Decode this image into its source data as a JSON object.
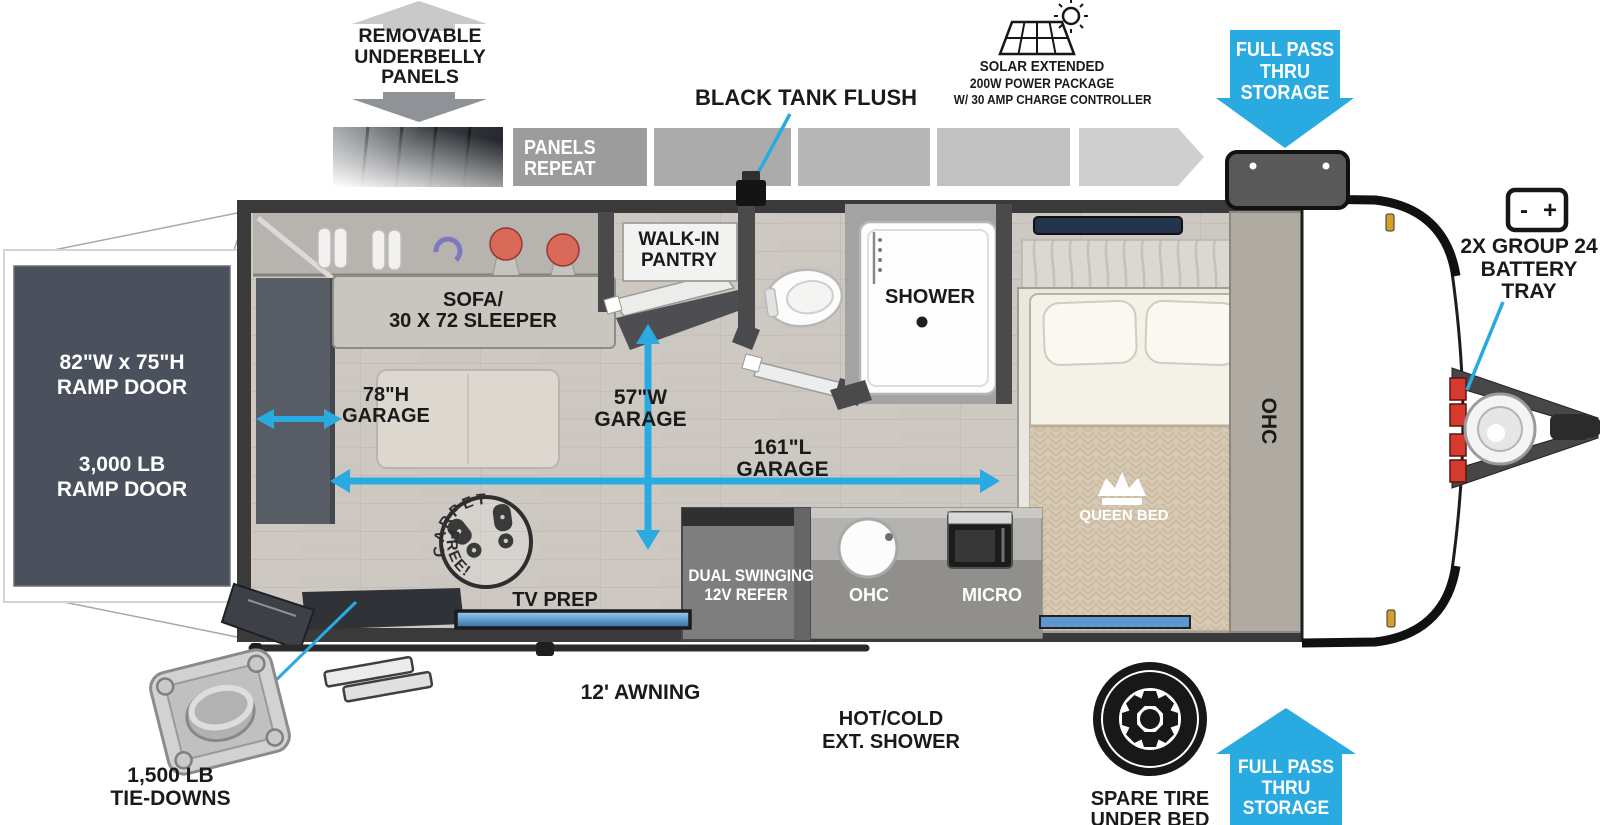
{
  "colors": {
    "accent_blue": "#29ABE2",
    "label_black": "#1a1a1a",
    "wall_gray": "#3a3a3a",
    "ramp_door_gray": "#4b515c",
    "floor_gray": "#cdc9c2"
  },
  "annotations": {
    "underbelly": {
      "lines": [
        "REMOVABLE",
        "UNDERBELLY",
        "PANELS"
      ]
    },
    "panels_repeat": {
      "lines": [
        "PANELS",
        "REPEAT"
      ]
    },
    "black_tank_flush": {
      "label": "BLACK TANK FLUSH"
    },
    "solar": {
      "lines": [
        "SOLAR EXTENDED",
        "200W POWER PACKAGE",
        "W/ 30 AMP CHARGE CONTROLLER"
      ]
    },
    "full_pass_top": {
      "lines": [
        "FULL PASS",
        "THRU",
        "STORAGE"
      ]
    },
    "battery_tray": {
      "minus": "-",
      "plus": "+",
      "lines": [
        "2X GROUP 24",
        "BATTERY",
        "TRAY"
      ]
    },
    "tie_downs": {
      "lines": [
        "1,500 LB",
        "TIE-DOWNS"
      ]
    },
    "awning": {
      "label": "12' AWNING"
    },
    "ext_shower": {
      "lines": [
        "HOT/COLD",
        "EXT. SHOWER"
      ]
    },
    "spare_tire": {
      "lines": [
        "SPARE TIRE",
        "UNDER BED"
      ]
    },
    "full_pass_bottom": {
      "lines": [
        "FULL PASS",
        "THRU",
        "STORAGE"
      ]
    }
  },
  "ramp_door": {
    "size_line1": "82\"W x 75\"H",
    "size_line2": "RAMP DOOR",
    "weight_line1": "3,000 LB",
    "weight_line2": "RAMP DOOR"
  },
  "rooms": {
    "sofa": {
      "lines": [
        "SOFA/",
        "30 X 72 SLEEPER"
      ]
    },
    "garage_height": {
      "lines": [
        "78\"H",
        "GARAGE"
      ]
    },
    "garage_width": {
      "lines": [
        "57\"W",
        "GARAGE"
      ]
    },
    "garage_length": {
      "lines": [
        "161\"L",
        "GARAGE"
      ]
    },
    "pantry": {
      "lines": [
        "WALK-IN",
        "PANTRY"
      ]
    },
    "shower": {
      "label": "SHOWER"
    },
    "queen_bed": {
      "label": "QUEEN BED"
    },
    "ohc_bedroom": {
      "label": "OHC"
    },
    "refrigerator": {
      "lines": [
        "DUAL SWINGING",
        "12V REFER"
      ]
    },
    "ohc_kitchen": {
      "label": "OHC"
    },
    "microwave": {
      "label": "MICRO"
    },
    "tv_prep": {
      "label": "TV PREP"
    },
    "carpet_free": {
      "top": "CARPET",
      "bottom": "FREE!"
    }
  }
}
